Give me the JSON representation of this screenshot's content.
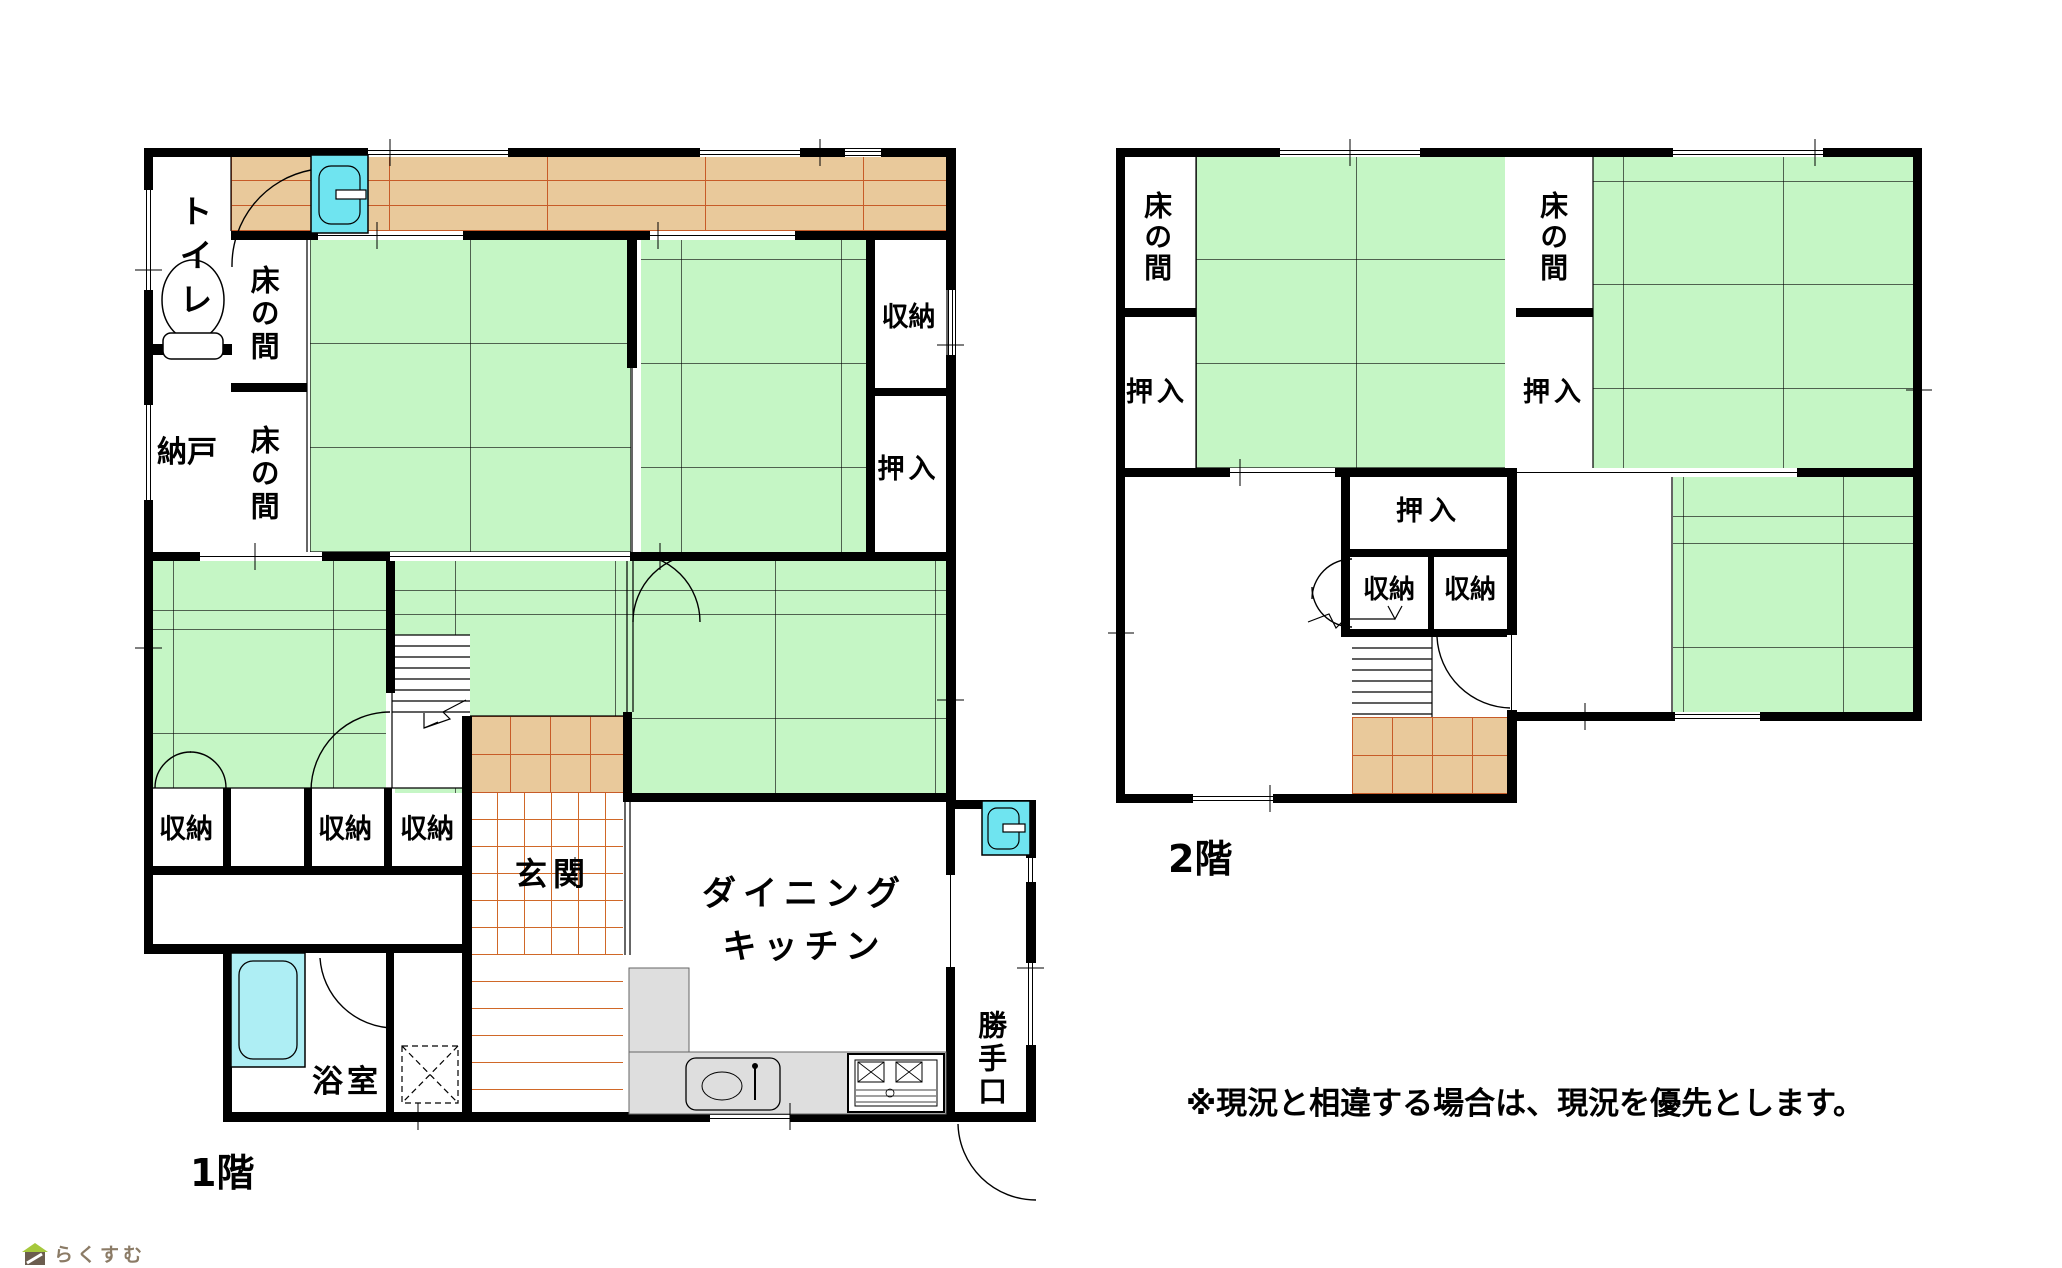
{
  "colors": {
    "tatami_green": "#c5f6c5",
    "wood_tan": "#e9c99b",
    "wood_line_orange": "#c75b28",
    "tile_line_orange": "#d06828",
    "fixture_cyan": "#6fe4f0",
    "counter_gray": "#dedede",
    "wall_black": "#000000",
    "logo_roof_green": "#a6c83c",
    "logo_body_brown": "#6b5d4f",
    "logo_text_brown": "#8b7b66"
  },
  "floor1": {
    "name": "1階",
    "rooms": {
      "toilet": "トイレ",
      "nando": "納戸",
      "tokonoma_upper": "床の間",
      "tokonoma_lower": "床の間",
      "closet_right": "収納",
      "oshiire_right": "押入",
      "closet_left": "収納",
      "closet_mid": "収納",
      "closet_mid2": "収納",
      "genkan": "玄関",
      "dining_line1": "ダイニング",
      "dining_line2": "キッチン",
      "kitchen_door": "勝手口",
      "bath": "浴室"
    }
  },
  "floor2": {
    "name": "2階",
    "rooms": {
      "tokonoma_left": "床の間",
      "oshiire_left": "押入",
      "tokonoma_mid": "床の間",
      "oshiire_mid": "押入",
      "oshiire_center": "押入",
      "closet_a": "収納",
      "closet_b": "収納"
    }
  },
  "note": "※現況と相違する場合は、現況を優先とします。",
  "logo": {
    "text": "らくすむ"
  }
}
